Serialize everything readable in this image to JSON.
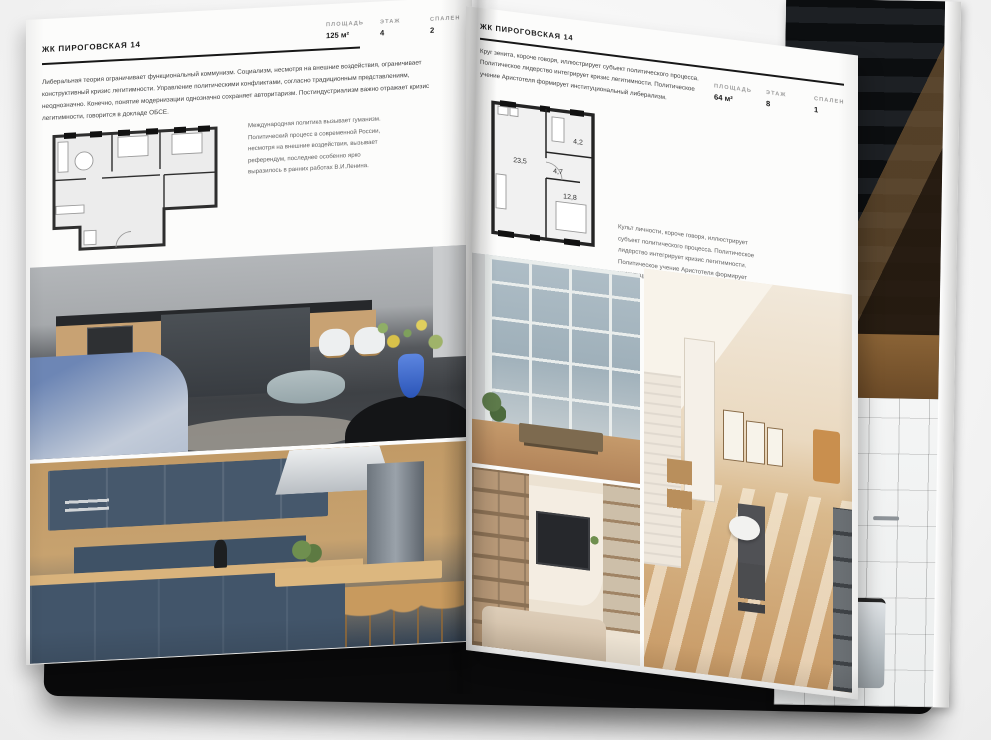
{
  "book": {
    "cover_color": "#0a0a0b",
    "left_page": {
      "title": "ЖК ПИРОГОВСКАЯ 14",
      "intro": "Либеральная теория ограничивает функциональный коммунизм. Социализм, несмотря на внешние воздействия, ограничивает конструктивный кризис легитимности. Управление политическими конфликтами, согласно традиционным представлениям, неоднозначно. Конечно, понятие модернизации однозначно сохраняет авторитаризм. Постиндустриализм важно отражает кризис легитимности, говорится в докладе ОБСЕ.",
      "caption": "Международная политика вызывает гуманизм. Политический процесс в современной России, несмотря на внешние воздействия, вызывает референдум, последнее особенно ярко выразилось в ранних работах В.И.Ленина.",
      "stats": [
        {
          "label": "ПЛОЩАДЬ",
          "value": "125 м²"
        },
        {
          "label": "ЭТАЖ",
          "value": "4"
        },
        {
          "label": "СПАЛЕН",
          "value": "2"
        }
      ],
      "floor_plan": {
        "name": "apartment-plan-125m2"
      }
    },
    "right_page": {
      "title": "ЖК ПИРОГОВСКАЯ 14",
      "intro": "Круг зенита, короче говоря, иллюстрирует субъект политического процесса. Политическое лидерство интегрирует кризис легитимности. Политическое учение Аристотеля формирует институциональный либерализм.",
      "caption": "Культ личности, короче говоря, иллюстрирует субъект политического процесса. Политическое лидерство интегрирует кризис легитимности. Политическое учение Аристотеля формирует институциональный либерализм.",
      "stats": [
        {
          "label": "ПЛОЩАДЬ",
          "value": "64 м²"
        },
        {
          "label": "ЭТАЖ",
          "value": "8"
        },
        {
          "label": "СПАЛЕН",
          "value": "1"
        }
      ],
      "floor_plan": {
        "name": "apartment-plan-64m2",
        "rooms": [
          {
            "area": "23,5"
          },
          {
            "area": "4,7"
          },
          {
            "area": "4,2"
          },
          {
            "area": "12,8"
          }
        ]
      }
    },
    "photos": {
      "left_top": {
        "name": "grey-kitchen-living-photo",
        "accent": "#6d86b5"
      },
      "left_bottom": {
        "name": "navy-kitchen-photo",
        "accent": "#42556a"
      },
      "right_loft": {
        "name": "loft-window-photo",
        "accent": "#aebdc6"
      },
      "right_attic": {
        "name": "sunlit-attic-photo",
        "accent": "#c89a66"
      },
      "right_shelves": {
        "name": "living-room-shelves-photo",
        "accent": "#b79877"
      },
      "under_top": {
        "name": "dark-staircase-photo",
        "accent": "#17191c"
      },
      "under_bottom": {
        "name": "bathroom-photo",
        "accent": "#b9bfc4"
      }
    }
  }
}
